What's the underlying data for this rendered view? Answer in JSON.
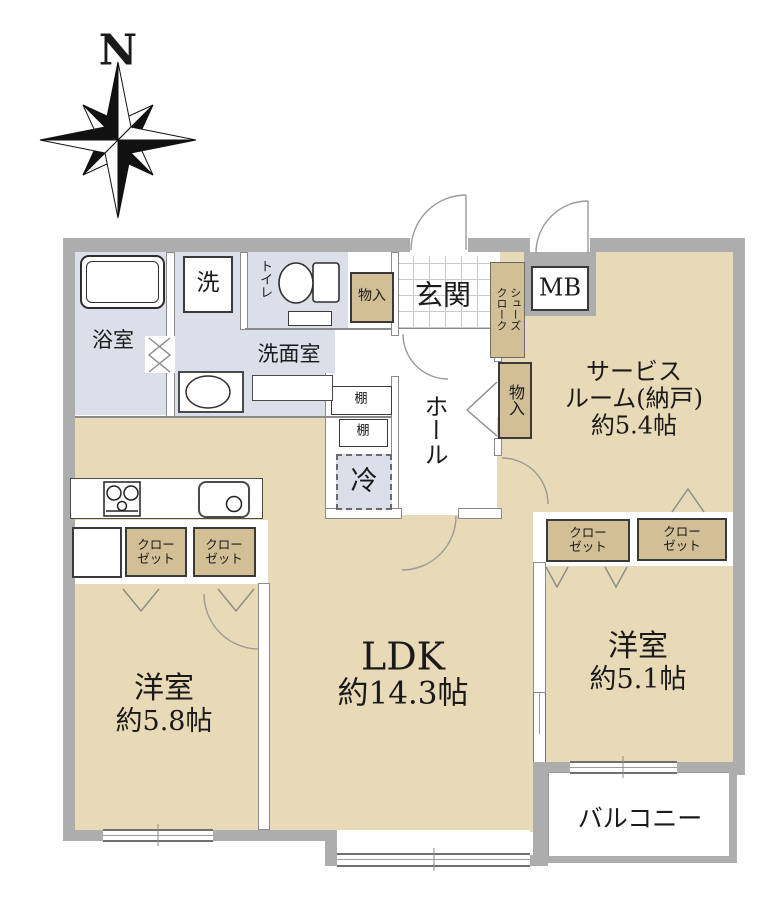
{
  "compass": {
    "north_label": "N"
  },
  "palette": {
    "room_tan": "#e8dab6",
    "storage_tan": "#d3bf96",
    "wet_blue": "#dbdfea",
    "wall_gray": "#adadad"
  },
  "plan": {
    "wet": {
      "bath": {
        "label": "浴室"
      },
      "washer": {
        "label": "洗"
      },
      "toilet": {
        "label": "トイレ"
      },
      "washroom": {
        "label": "洗面室"
      }
    },
    "entrance": {
      "label": "玄関",
      "storage_label": "物入",
      "shoe_closet_label": "シューズ\nクローク",
      "meter_box_label": "MB"
    },
    "hall": {
      "label": "ホール",
      "shelf1_label": "棚",
      "shelf2_label": "棚",
      "fridge_label": "冷",
      "storage_label": "物入"
    },
    "service_room": {
      "line1": "サービス",
      "line2": "ルーム(納戸)",
      "line3": "約5.4帖"
    },
    "closets": [
      {
        "line1": "クロー",
        "line2": "ゼット"
      },
      {
        "line1": "クロー",
        "line2": "ゼット"
      },
      {
        "line1": "クロー",
        "line2": "ゼット"
      },
      {
        "line1": "クロー",
        "line2": "ゼット"
      }
    ],
    "bedroom_west": {
      "name": "洋室",
      "size": "約5.8帖"
    },
    "ldk": {
      "name": "LDK",
      "size": "約14.3帖"
    },
    "bedroom_east": {
      "name": "洋室",
      "size": "約5.1帖"
    },
    "balcony": {
      "label": "バルコニー"
    }
  }
}
